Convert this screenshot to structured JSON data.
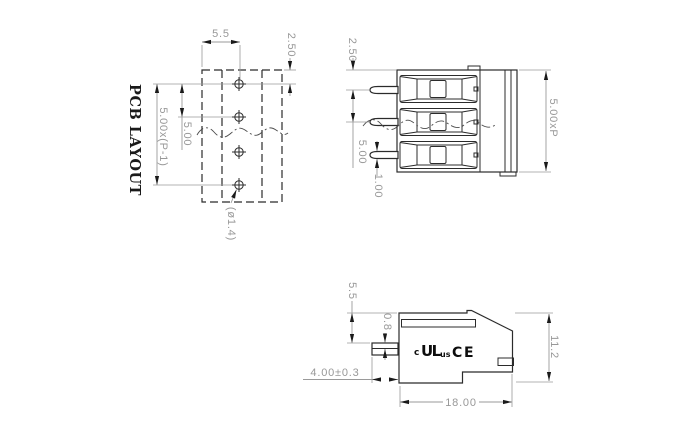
{
  "pcb_view": {
    "title": "PCB LAYOUT",
    "dim_footprint_width": "5.5",
    "dim_edge_to_hole": "2.50",
    "dim_hole_span": "5.00x(P-1)",
    "dim_hole_pitch": "5.00",
    "dim_hole_diameter": "(ø1.4)"
  },
  "front_view": {
    "dim_edge_to_pin": "2.50",
    "dim_pin_pitch": "5.00",
    "dim_pin_width": "1.00",
    "dim_overall_length": "5.00xP"
  },
  "side_view": {
    "dim_top_to_pin": "5.5",
    "dim_pin_thickness": "0.8",
    "dim_pin_length": "4.00±0.3",
    "dim_body_depth": "18.00",
    "dim_body_height": "11.2",
    "cert_c": "c",
    "cert_ul": "UL",
    "cert_us": "us",
    "cert_ce_c": "C",
    "cert_ce_e": "E"
  },
  "colors": {
    "outline": "#2b2b2b",
    "dimension": "#9a9a9a",
    "arrow": "#1a1a1a",
    "title_text": "#1a1a1a",
    "background": "#ffffff"
  }
}
